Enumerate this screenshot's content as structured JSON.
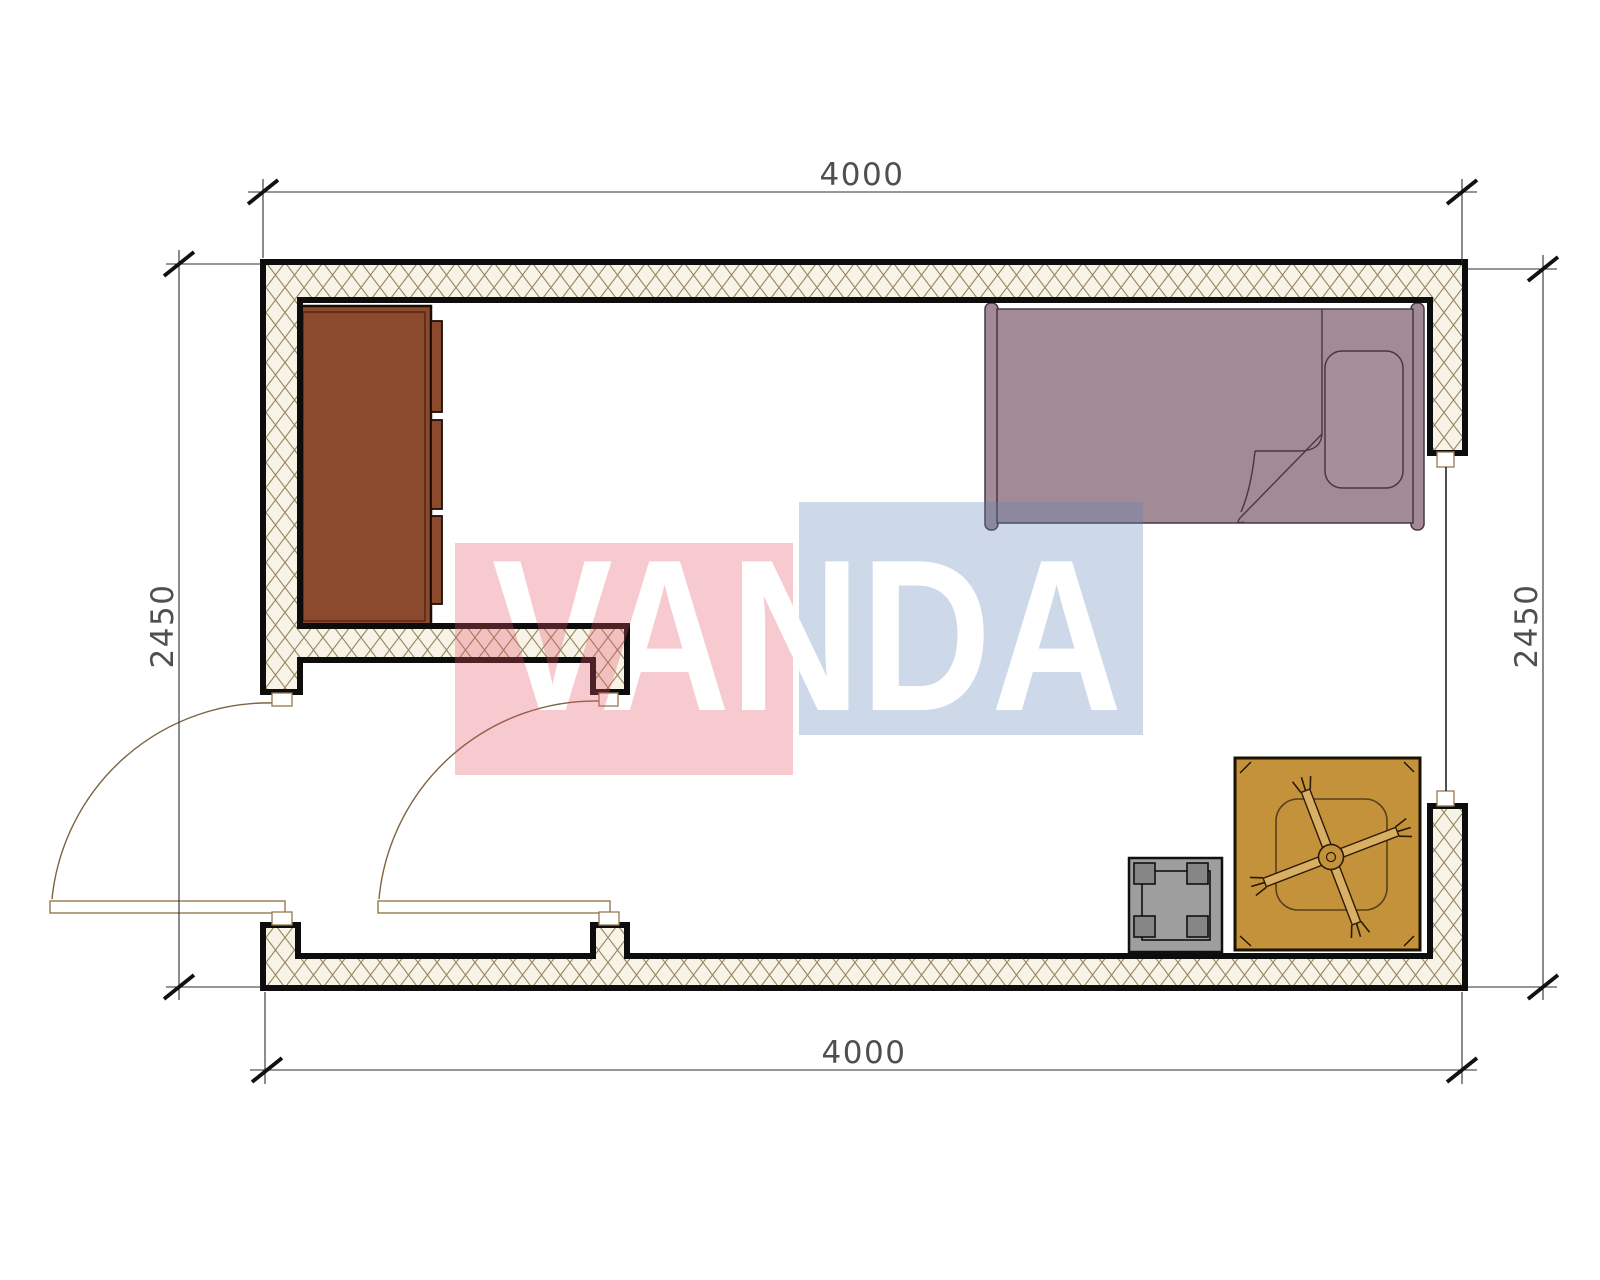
{
  "title": "room-floor-plan",
  "dimensions": {
    "top": "4000",
    "bottom": "4000",
    "left": "2450",
    "right": "2450"
  },
  "watermark": {
    "text": "VANDA",
    "pink_color": "#E44E62",
    "blue_color": "#5880B5",
    "opacity": "0.30"
  },
  "plan": {
    "wall_fill": "#f8f3e7",
    "hatch_line_color": "#95875f",
    "wall_stroke": "#0d0d0d",
    "furniture": [
      {
        "name": "wardrobe",
        "color": "#8b4a2d"
      },
      {
        "name": "single-bed",
        "color": "#a28b96"
      },
      {
        "name": "table-with-x-frame",
        "color": "#c5923c"
      },
      {
        "name": "stool",
        "color": "#9e9e9e"
      }
    ],
    "openings": [
      {
        "name": "entry-door-left"
      },
      {
        "name": "interior-door"
      },
      {
        "name": "window-right"
      }
    ]
  }
}
